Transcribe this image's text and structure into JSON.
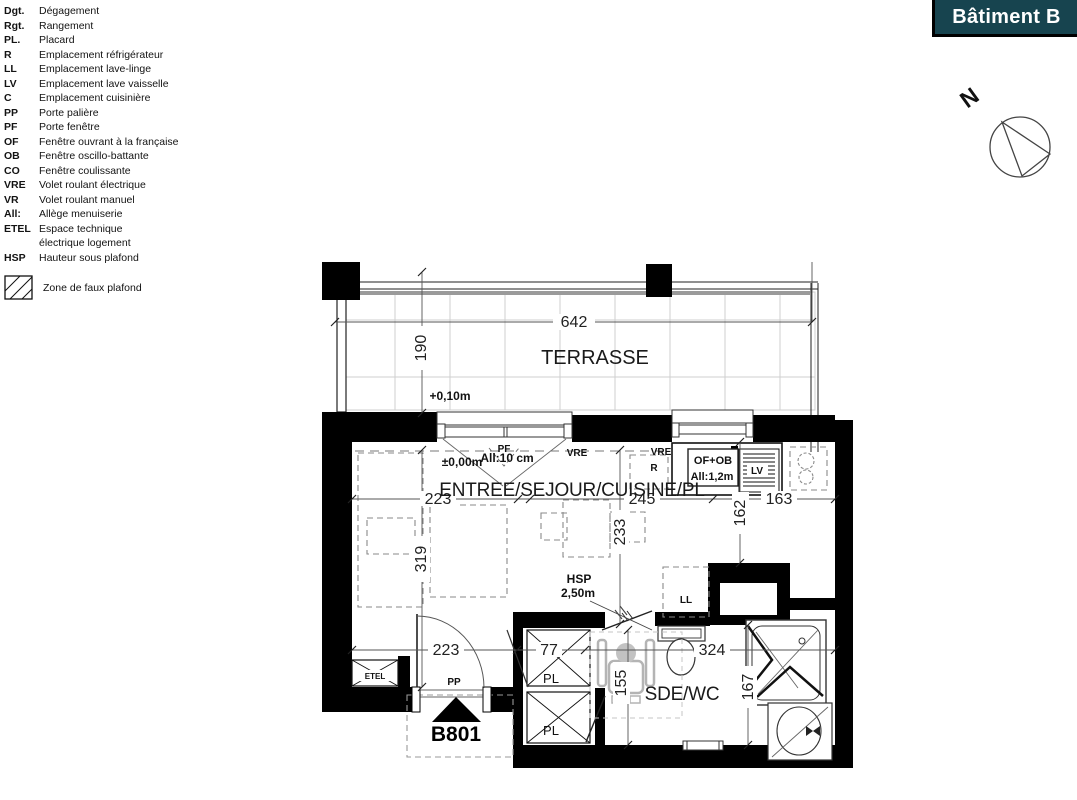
{
  "banner": {
    "title": "Bâtiment B",
    "bg_color": "#17444f",
    "text_color": "#ffffff"
  },
  "north_arrow": {
    "label": "N"
  },
  "legend": {
    "items": [
      {
        "abbr": "Dgt.",
        "label": "Dégagement"
      },
      {
        "abbr": "Rgt.",
        "label": "Rangement"
      },
      {
        "abbr": "PL.",
        "label": "Placard"
      },
      {
        "abbr": "R",
        "label": "Emplacement réfrigérateur"
      },
      {
        "abbr": "LL",
        "label": "Emplacement lave-linge"
      },
      {
        "abbr": "LV",
        "label": "Emplacement lave vaisselle"
      },
      {
        "abbr": "C",
        "label": "Emplacement cuisinière"
      },
      {
        "abbr": "PP",
        "label": "Porte palière"
      },
      {
        "abbr": "PF",
        "label": "Porte fenêtre"
      },
      {
        "abbr": "OF",
        "label": "Fenêtre ouvrant à la française"
      },
      {
        "abbr": "OB",
        "label": "Fenêtre oscillo-battante"
      },
      {
        "abbr": "CO",
        "label": "Fenêtre coulissante"
      },
      {
        "abbr": "VRE",
        "label": "Volet roulant électrique"
      },
      {
        "abbr": "VR",
        "label": "Volet roulant manuel"
      },
      {
        "abbr": "All:",
        "label": "Allège menuiserie"
      },
      {
        "abbr": "ETEL",
        "label": "Espace technique\nélectrique logement"
      },
      {
        "abbr": "HSP",
        "label": "Hauteur sous plafond"
      }
    ],
    "hatch_label": "Zone de faux plafond"
  },
  "plan": {
    "unit_number": "B801",
    "rooms": {
      "terrace": "TERRASSE",
      "living": "ENTREE/SEJOUR/CUISINE/PL",
      "bathroom": "SDE/WC"
    },
    "levels": {
      "terrace": "+0,10m",
      "living": "±0,00m"
    },
    "annotations": {
      "allege_living": "All:10 cm",
      "kitchen_window_type": "OF+OB",
      "kitchen_window_allege": "All:1,2m",
      "ceiling_height_abbr": "HSP",
      "ceiling_height_value": "2,50m",
      "door_entry": "PP",
      "window_living": "PF",
      "shutter_living": "VRE",
      "shutter_kitchen": "VRE",
      "fridge": "R",
      "dishwasher": "LV",
      "washer": "LL",
      "closet_top": "PL",
      "closet_bottom": "PL",
      "technical": "ETEL"
    },
    "dimensions": {
      "terrace_width": "642",
      "terrace_depth": "190",
      "living_left_width": "223",
      "living_right_width": "245",
      "kitchen_width": "163",
      "kitchen_depth": "162",
      "living_depth": "319",
      "living_mid_depth": "233",
      "entry_width": "223",
      "closet_width": "77",
      "bathroom_width": "324",
      "bathroom_left_depth": "155",
      "bathroom_right_depth": "167"
    }
  }
}
